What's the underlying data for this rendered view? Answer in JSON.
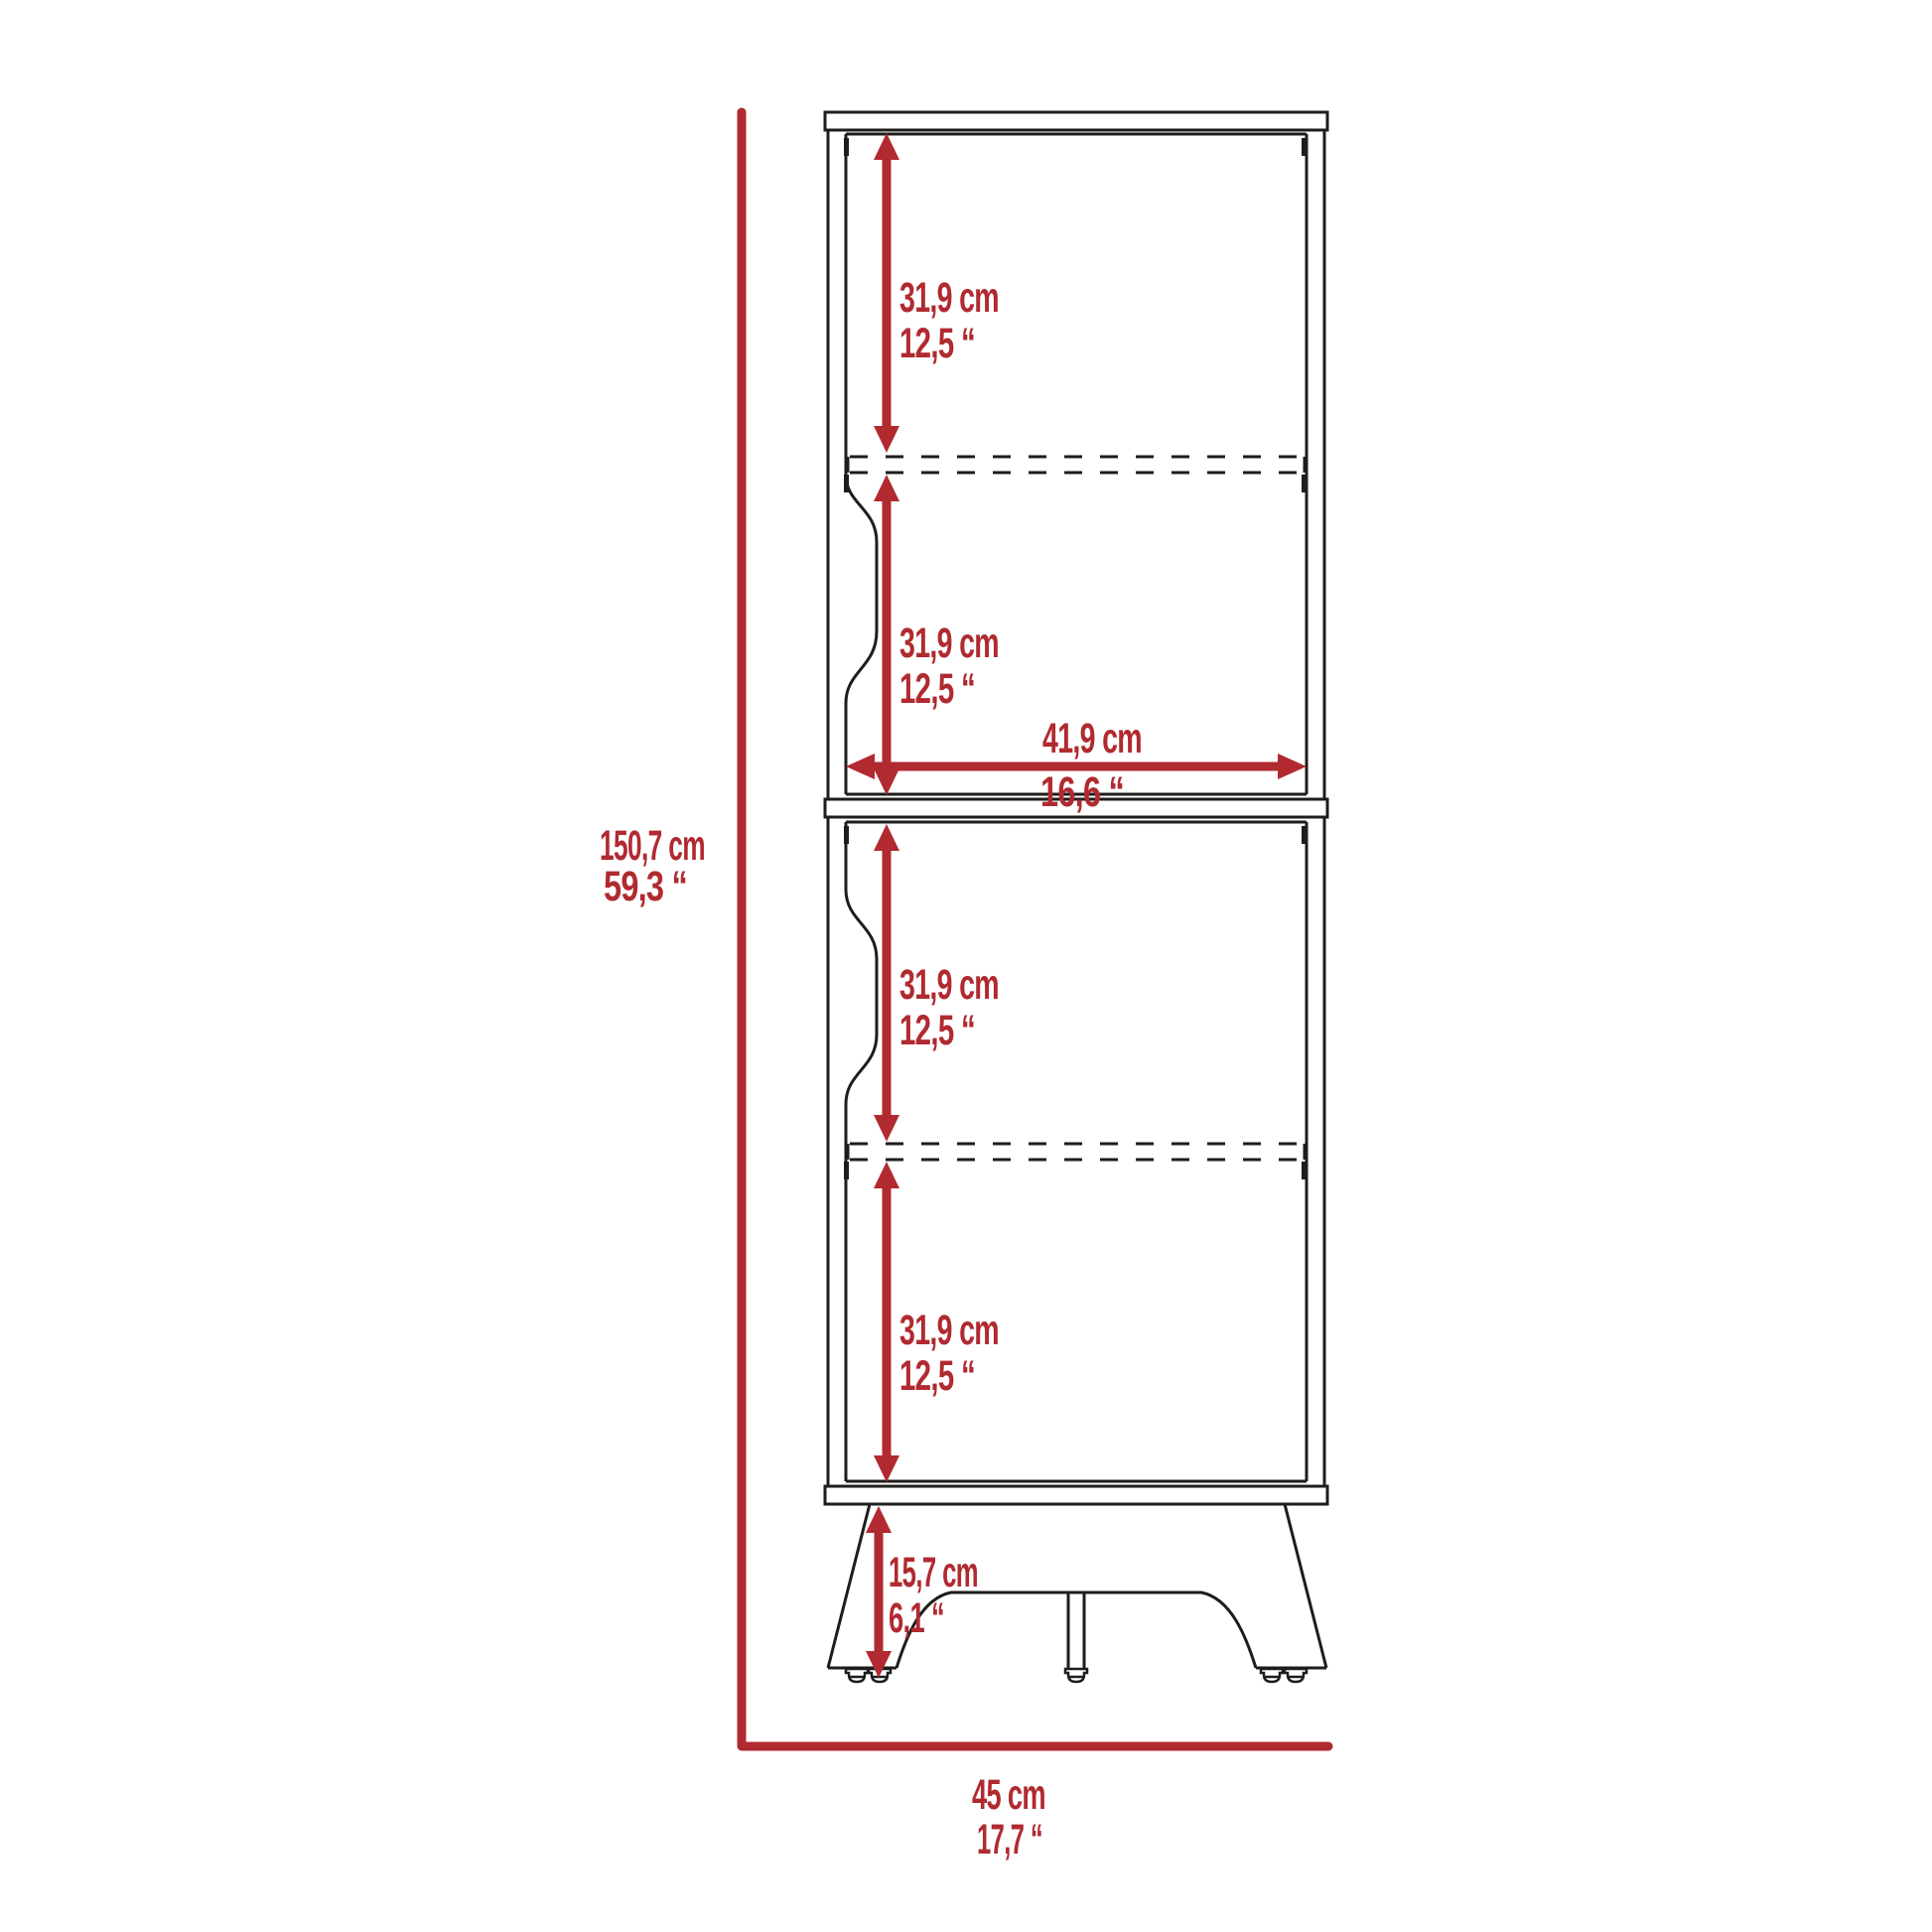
{
  "diagram": {
    "type": "furniture dimension drawing (2-door tall cabinet, front view)",
    "colors": {
      "accent_red": "#b02a30",
      "line_black": "#1d1d1b",
      "background": "#ffffff"
    },
    "labels": {
      "overall_height": {
        "cm": "150,7 cm",
        "inch": "59,3 “"
      },
      "overall_width": {
        "cm": "45 cm",
        "inch": "17,7 “"
      },
      "interior_width": {
        "cm": "41,9 cm",
        "inch": "16,6 “"
      },
      "leg_height": {
        "cm": "15,7 cm",
        "inch": "6,1 “"
      },
      "sections": [
        {
          "cm": "31,9 cm",
          "inch": "12,5 “"
        },
        {
          "cm": "31,9 cm",
          "inch": "12,5 “"
        },
        {
          "cm": "31,9 cm",
          "inch": "12,5 “"
        },
        {
          "cm": "31,9 cm",
          "inch": "12,5 “"
        }
      ]
    }
  }
}
